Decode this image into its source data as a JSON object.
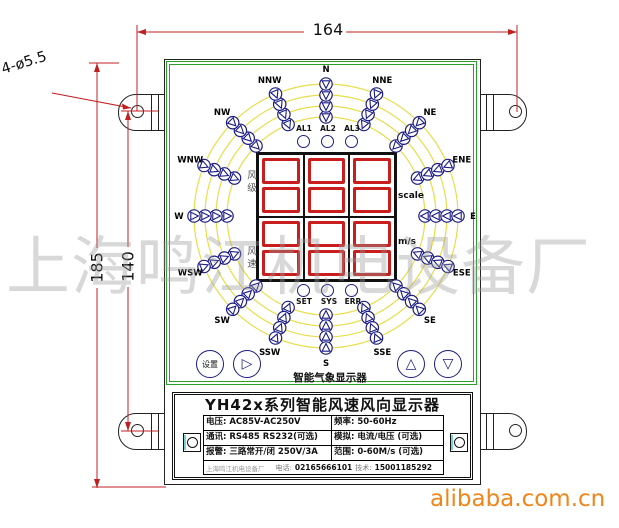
{
  "page": {
    "watermark": "上海鸣江机电设备厂",
    "brand": "alibaba.com.cn"
  },
  "dimensions": {
    "width": "164",
    "height": "185",
    "hole_spacing": "140",
    "mounting_holes": "4-ø5.5"
  },
  "device": {
    "caption": "智能气象显示器",
    "title": "YH42x系列智能风速风向显示器",
    "display_rows": [
      {
        "cn": "风级",
        "unit": "scale"
      },
      {
        "cn": "风速",
        "unit": "m/s"
      }
    ],
    "alarm_leds": [
      "AL1",
      "AL2",
      "AL3"
    ],
    "status_leds": [
      "SET",
      "SYS",
      "ERR"
    ],
    "buttons": [
      {
        "name": "set",
        "label": "设置"
      },
      {
        "name": "next",
        "label": "▷"
      },
      {
        "name": "up",
        "label": "△"
      },
      {
        "name": "down",
        "label": "▽"
      }
    ],
    "compass": {
      "directions": [
        "N",
        "NNE",
        "NE",
        "ENE",
        "E",
        "ESE",
        "SE",
        "SSE",
        "S",
        "SSW",
        "SW",
        "WSW",
        "W",
        "WNW",
        "NW",
        "NNW"
      ],
      "leds_per_direction": 4
    },
    "spec_table": {
      "rows": [
        {
          "left": "电压: AC85V-AC250V",
          "right": "频率: 50-60Hz"
        },
        {
          "left": "通讯: RS485 RS232(可选)",
          "right": "模拟: 电流/电压 (可选)"
        },
        {
          "left": "报警: 三路常开/闭 250V/3A",
          "right": "范围: 0-60M/s (可选)"
        }
      ],
      "footer": {
        "company": "上海鸣江机电设备厂",
        "phone_label": "电话:",
        "phone": "02165666101",
        "tech_label": "技术:",
        "tech": "15001185292"
      }
    },
    "colors": {
      "frame_green": "#2aa02a",
      "arc_yellow": "#e8dd4a",
      "led_navy": "#1c1c85",
      "segment_red": "#c81e1e",
      "dimension_red": "#c02020",
      "brand_orange": "#f08519"
    }
  }
}
